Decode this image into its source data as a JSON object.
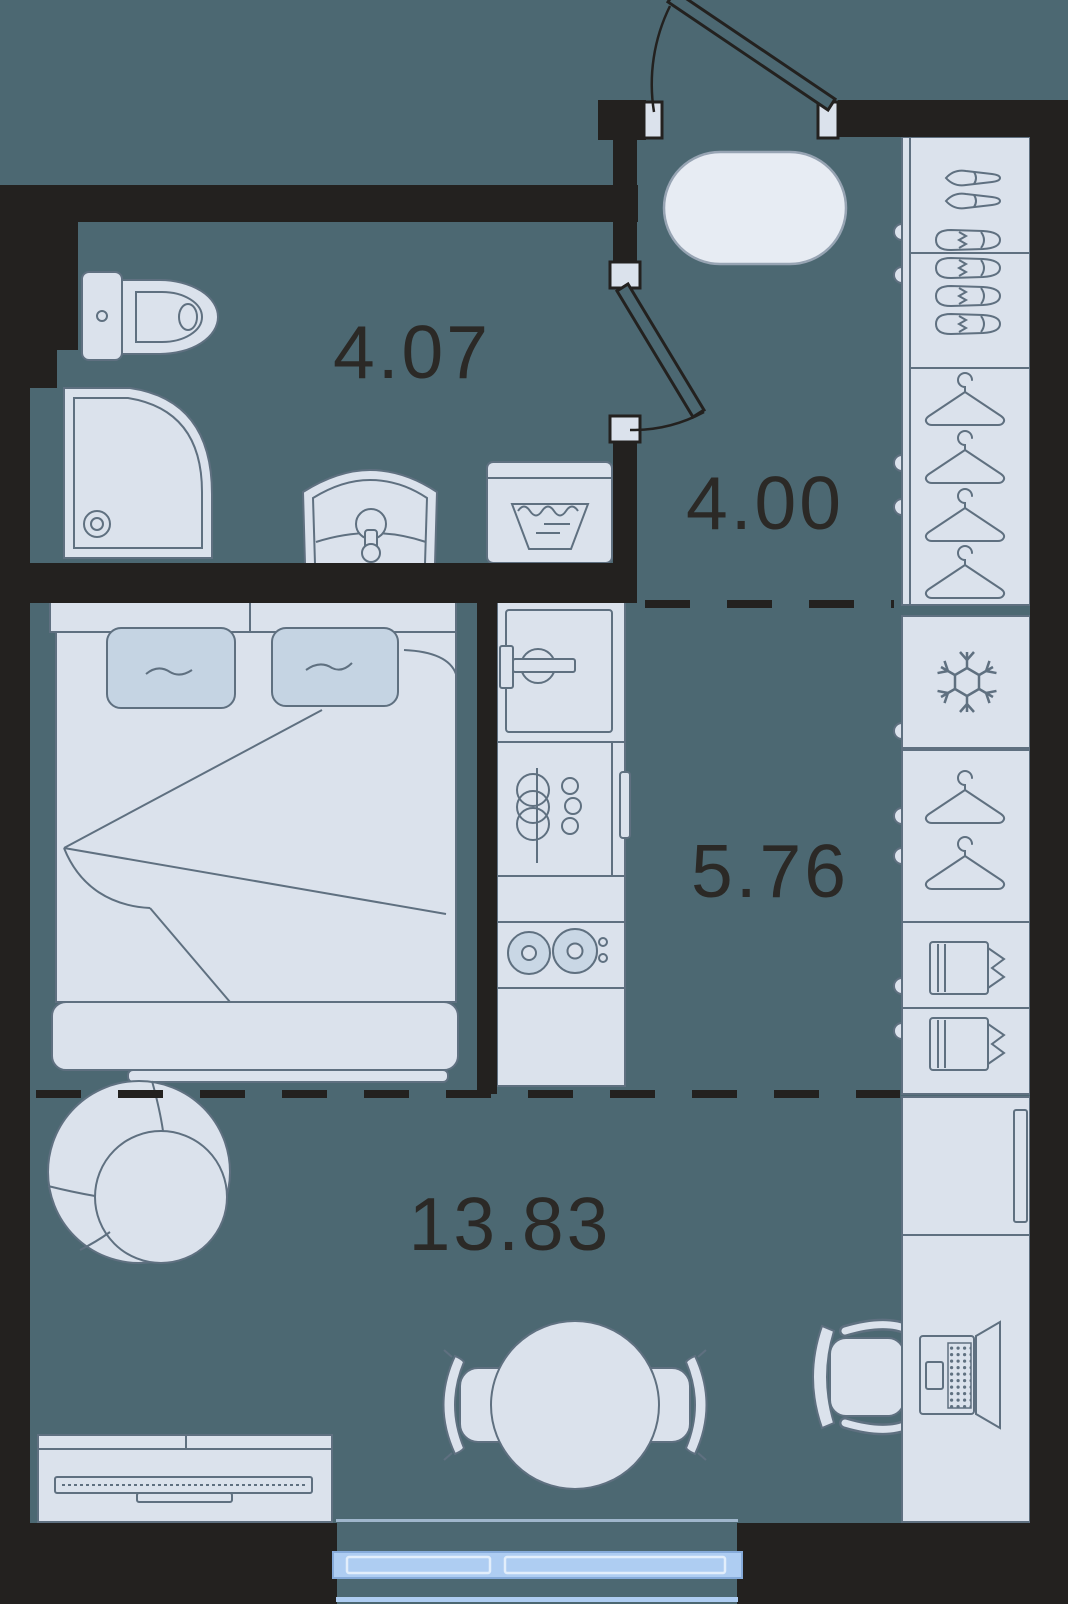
{
  "plan": {
    "rooms": [
      {
        "key": "bathroom",
        "area": "4.07"
      },
      {
        "key": "hallway",
        "area": "4.00"
      },
      {
        "key": "kitchen",
        "area": "5.76"
      },
      {
        "key": "living-room",
        "area": "13.83"
      }
    ]
  },
  "colors": {
    "background": "#4C6872",
    "wall": "#23211F",
    "furniture_fill": "#DBE2EC",
    "furniture_stroke": "#5F7080",
    "pillow_fill": "#C5D4E3",
    "rug_fill": "#E7ECF3",
    "window_blue": "#AECDF2",
    "label_text": "#2B2926"
  },
  "furniture_icons": [
    "toilet-icon",
    "shower-icon",
    "sink-icon",
    "washing-machine-icon",
    "double-bed-icon",
    "kitchen-sink-icon",
    "dish-rack-icon",
    "stove-icon",
    "oven-handle-icon",
    "entry-rug-icon",
    "heels-icon",
    "sneakers-icon",
    "clothes-hanger-icon",
    "snowflake-icon",
    "folded-shirt-icon",
    "armchair-icon",
    "dining-table-icon",
    "dining-chair-icon",
    "tv-stand-icon",
    "tv-icon",
    "desk-icon",
    "laptop-icon",
    "office-chair-icon",
    "window-icon",
    "entrance-door-icon",
    "bathroom-door-icon"
  ]
}
